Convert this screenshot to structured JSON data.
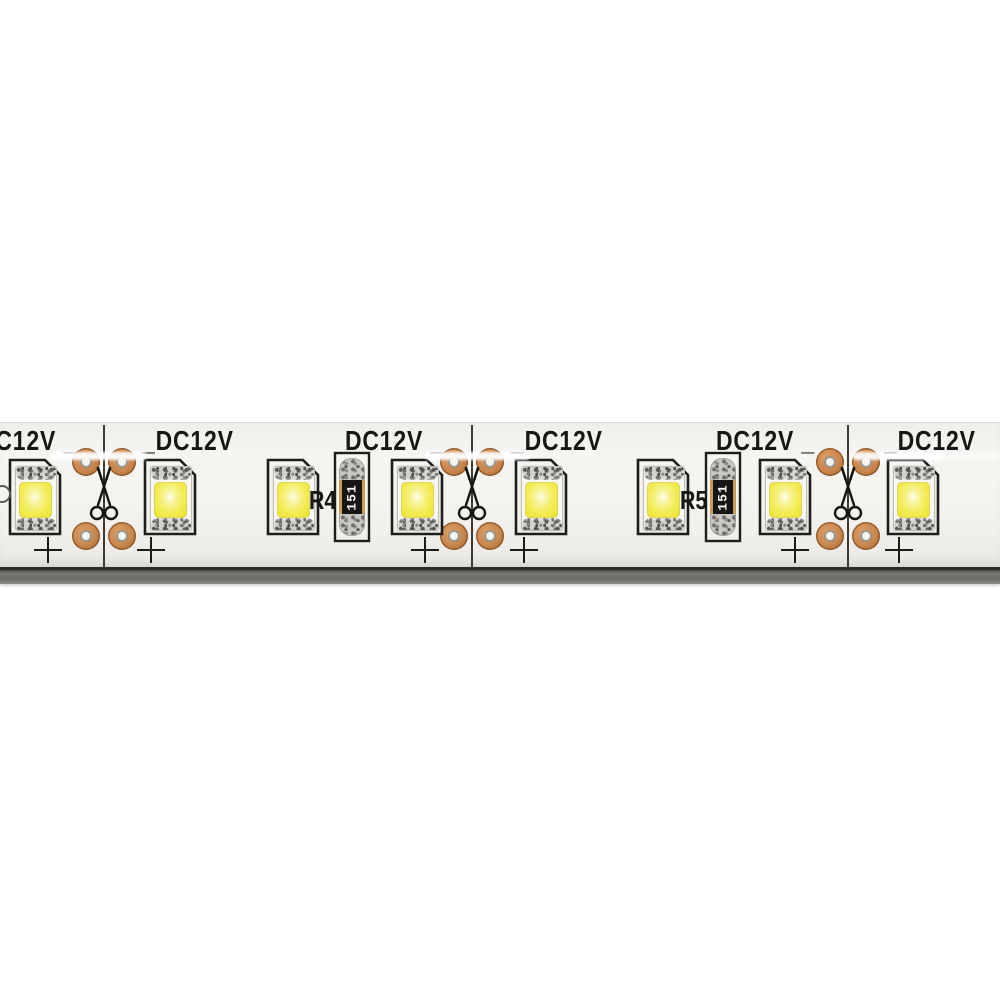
{
  "product": {
    "name": "flexible LED strip light, white PCB, warm-white SMD LEDs",
    "voltage_label": "DC12V",
    "resistor_code": "151",
    "polarity_symbol": "+",
    "colors": {
      "pcb_surface": "#f5f3ef",
      "strip_side_edge": "#70746d",
      "copper_pad": "#c8854e",
      "led_phosphor_yellow": "#f2ec55",
      "silkscreen_black": "#1d1d1b",
      "background": "#ffffff"
    }
  },
  "strip": {
    "cuts": [
      {
        "x": 104
      },
      {
        "x": 472
      },
      {
        "x": 848
      }
    ],
    "voltage_labels": [
      {
        "x": -22,
        "text": "DC12V _"
      },
      {
        "x": 142,
        "text": "_DC12V"
      },
      {
        "x": 345,
        "text": "DC12V _"
      },
      {
        "x": 511,
        "text": "_DC12V"
      },
      {
        "x": 716,
        "text": "DC12V _"
      },
      {
        "x": 884,
        "text": "_DC12V"
      }
    ],
    "leds": [
      {
        "x": 8
      },
      {
        "x": 143
      },
      {
        "x": 266
      },
      {
        "x": 390
      },
      {
        "x": 514
      },
      {
        "x": 636
      },
      {
        "x": 758
      },
      {
        "x": 886
      }
    ],
    "resistors": [
      {
        "x": 333,
        "label": "R4",
        "code": "151"
      },
      {
        "x": 704,
        "label": "R5",
        "code": "151"
      }
    ],
    "plus_marks": [
      {
        "x": 48
      },
      {
        "x": 151
      },
      {
        "x": 425
      },
      {
        "x": 524
      },
      {
        "x": 795
      },
      {
        "x": 899
      }
    ],
    "glare_streaks": [
      {
        "x": 52,
        "w": 95,
        "opacity": 0.95
      },
      {
        "x": 425,
        "w": 105,
        "opacity": 0.95
      },
      {
        "x": 852,
        "w": 90,
        "opacity": 0.9
      },
      {
        "x": 932,
        "w": 68,
        "opacity": 0.4
      }
    ]
  }
}
